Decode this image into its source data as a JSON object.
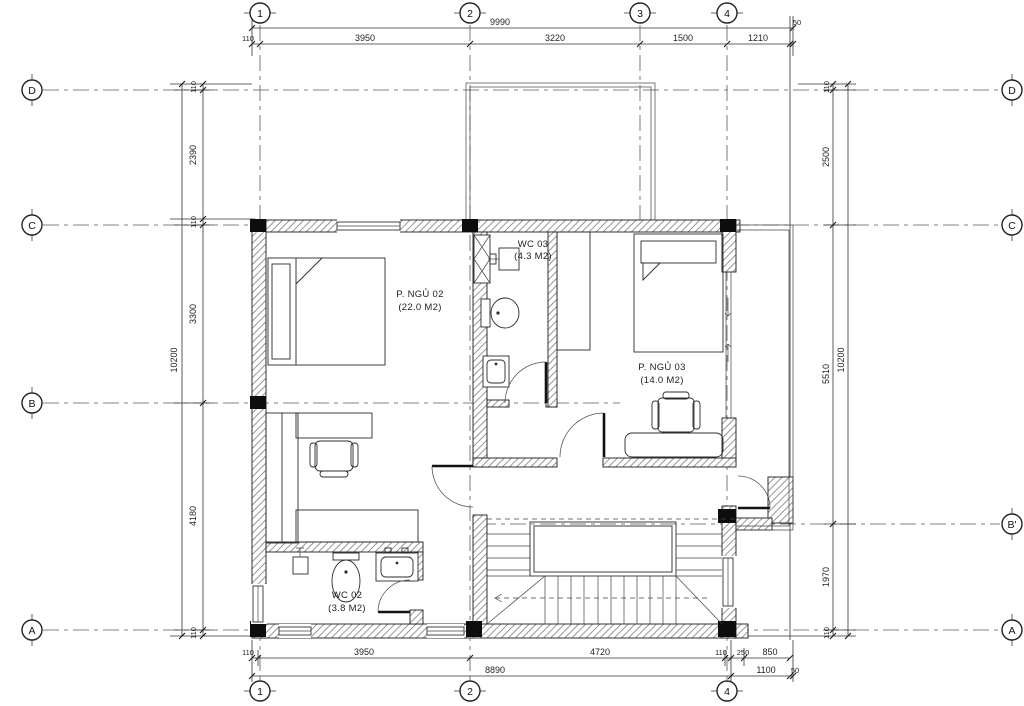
{
  "plan": {
    "rooms": [
      {
        "name": "P. NGỦ 02",
        "area": "(22.0 M2)"
      },
      {
        "name": "WC 03",
        "area": "(4.3 M2)"
      },
      {
        "name": "P. NGỦ 03",
        "area": "(14.0 M2)"
      },
      {
        "name": "WC 02",
        "area": "(3.8 M2)"
      }
    ],
    "grid_bubbles": {
      "top": [
        "1",
        "2",
        "3",
        "4"
      ],
      "bottom": [
        "1",
        "2",
        "4"
      ],
      "left": [
        "D",
        "C",
        "B",
        "A"
      ],
      "right": [
        "D",
        "C",
        "B'",
        "A"
      ]
    },
    "dims": {
      "top_overall": "9990",
      "top": [
        "110",
        "3950",
        "3220",
        "1500",
        "1210",
        "50"
      ],
      "bottom": [
        "110",
        "3950",
        "4720",
        "110",
        "250",
        "850"
      ],
      "bottom_overall": [
        "8890",
        "1100",
        "50"
      ],
      "left": [
        "110",
        "2390",
        "110",
        "3300",
        "4180",
        "110"
      ],
      "left_overall": "10200",
      "right": [
        "110",
        "2500",
        "5510",
        "1970",
        "110"
      ],
      "right_overall": "10200"
    },
    "line_color": "#1a1a1a",
    "hatch_color": "#8a8a8a"
  }
}
